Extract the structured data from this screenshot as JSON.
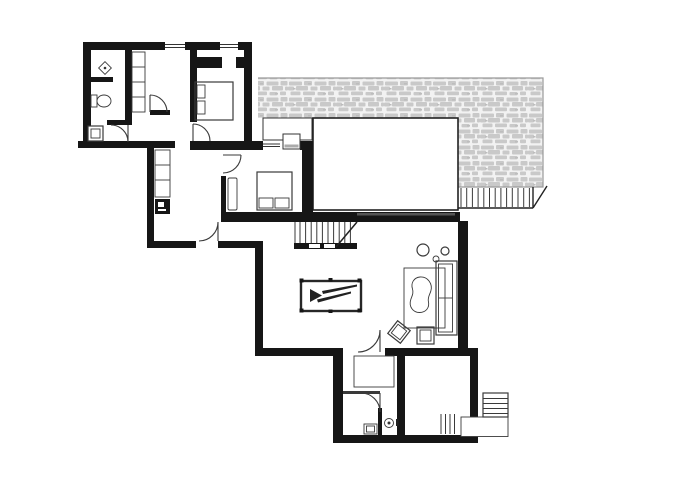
{
  "document": {
    "type": "architectural-floor-plan",
    "visible_text": []
  },
  "colors": {
    "background": "#ffffff",
    "wall": "#161616",
    "line": "#3a3a3a",
    "thin": "#555555",
    "stone": "#c9c9c9",
    "stone_bg": "#f2f2f2",
    "stone_edge": "#9a9a9a",
    "window_sill": "#aaaaaa",
    "handrail": "#555555"
  },
  "inventory": {
    "rooms": [
      "bathroom",
      "walk-in-closet",
      "bedroom-top",
      "hallway-closet",
      "bedroom-middle",
      "living-room",
      "storage-room",
      "wc",
      "entry-room",
      "stone-terrace",
      "roof-void"
    ],
    "furniture": [
      "double-bed-top",
      "double-bed-middle",
      "dresser",
      "wardrobe-band",
      "pool-table",
      "sofa",
      "rug-with-sheepskin",
      "coffee-table",
      "side-chair",
      "side-table",
      "plant-circles",
      "storage-cabinet"
    ],
    "fixtures": [
      "shower-drain",
      "toilet-top",
      "washing-machine",
      "hall-appliance",
      "wc-sink",
      "wc-toilet"
    ],
    "circulation": [
      "interior-stairs",
      "terrace-stairs",
      "exterior-entry-steps",
      "entry-landing",
      "interior-doors"
    ]
  }
}
